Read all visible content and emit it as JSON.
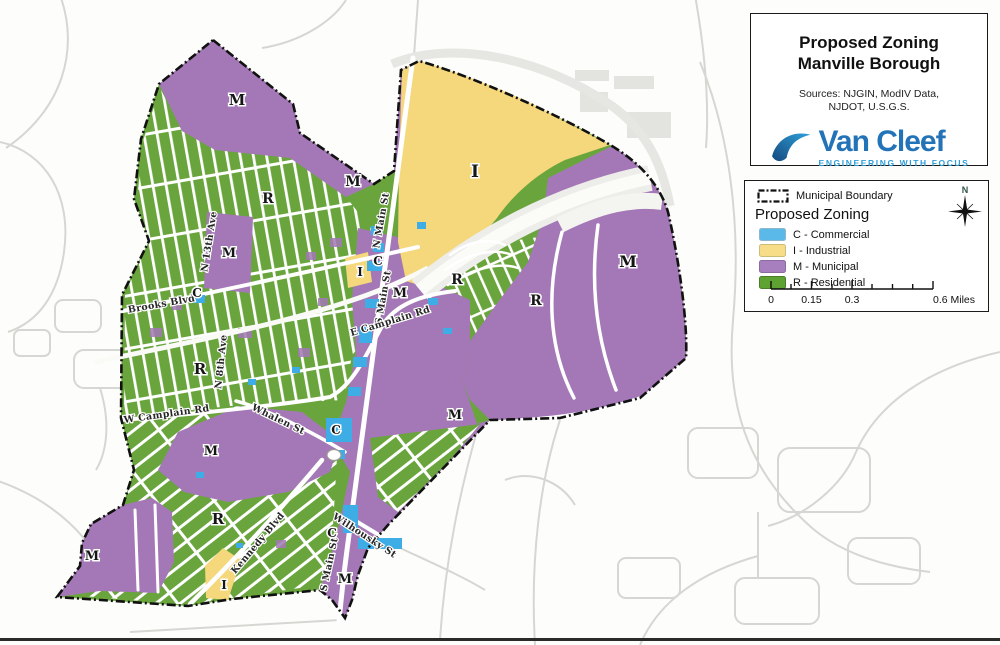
{
  "title_block": {
    "line1": "Proposed Zoning",
    "line2": "Manville Borough",
    "sources1": "Sources: NJGIN, ModIV Data,",
    "sources2": "NJDOT, U.S.G.S.",
    "logo_text": "Van Cleef",
    "logo_tagline": "ENGINEERING WITH FOCUS"
  },
  "legend": {
    "boundary_label": "Municipal Boundary",
    "heading": "Proposed Zoning",
    "items": [
      {
        "code": "C",
        "label": "C - Commercial",
        "color": "#5bb9ea"
      },
      {
        "code": "I",
        "label": "I - Industrial",
        "color": "#f8dd88"
      },
      {
        "code": "M",
        "label": "M - Municipal",
        "color": "#a87fbe"
      },
      {
        "code": "R",
        "label": "R - Residential",
        "color": "#5ea232"
      }
    ]
  },
  "scale_bar": {
    "labels": [
      "0",
      "0.15",
      "0.3",
      "0.6 Miles"
    ]
  },
  "north_label": "N",
  "colors": {
    "residential_green": "#69a53c",
    "municipal_purple": "#a478b6",
    "industrial_yellow": "#f5d77c",
    "commercial_blue": "#3fade5",
    "boundary_black": "#111111"
  },
  "map": {
    "zone_labels": [
      {
        "t": "M",
        "x": 237,
        "y": 105,
        "s": 15
      },
      {
        "t": "M",
        "x": 353,
        "y": 186,
        "s": 14
      },
      {
        "t": "I",
        "x": 475,
        "y": 177,
        "s": 17
      },
      {
        "t": "R",
        "x": 268,
        "y": 203,
        "s": 14
      },
      {
        "t": "M",
        "x": 229,
        "y": 257,
        "s": 13
      },
      {
        "t": "C",
        "x": 197,
        "y": 297,
        "s": 12
      },
      {
        "t": "I",
        "x": 360,
        "y": 276,
        "s": 12
      },
      {
        "t": "C",
        "x": 378,
        "y": 265,
        "s": 12
      },
      {
        "t": "M",
        "x": 400,
        "y": 297,
        "s": 13
      },
      {
        "t": "M",
        "x": 628,
        "y": 267,
        "s": 16
      },
      {
        "t": "R",
        "x": 457,
        "y": 284,
        "s": 14
      },
      {
        "t": "R",
        "x": 536,
        "y": 305,
        "s": 14
      },
      {
        "t": "R",
        "x": 200,
        "y": 374,
        "s": 15
      },
      {
        "t": "M",
        "x": 211,
        "y": 455,
        "s": 13
      },
      {
        "t": "C",
        "x": 336,
        "y": 434,
        "s": 12
      },
      {
        "t": "M",
        "x": 455,
        "y": 419,
        "s": 13
      },
      {
        "t": "R",
        "x": 218,
        "y": 524,
        "s": 15
      },
      {
        "t": "M",
        "x": 92,
        "y": 560,
        "s": 13
      },
      {
        "t": "C",
        "x": 332,
        "y": 537,
        "s": 12
      },
      {
        "t": "I",
        "x": 224,
        "y": 589,
        "s": 12
      },
      {
        "t": "M",
        "x": 345,
        "y": 583,
        "s": 13
      }
    ],
    "street_labels": [
      {
        "t": "Brooks Blvd",
        "x": 162,
        "y": 307,
        "r": -10
      },
      {
        "t": "N 13th Ave",
        "x": 212,
        "y": 242,
        "r": -81
      },
      {
        "t": "N 8th Ave",
        "x": 224,
        "y": 362,
        "r": -84
      },
      {
        "t": "N Main St",
        "x": 384,
        "y": 221,
        "r": -80
      },
      {
        "t": "S Main St",
        "x": 386,
        "y": 298,
        "r": -80
      },
      {
        "t": "E Camplain Rd",
        "x": 391,
        "y": 324,
        "r": -17
      },
      {
        "t": "W Camplain Rd",
        "x": 167,
        "y": 417,
        "r": -8
      },
      {
        "t": "Whalen St",
        "x": 277,
        "y": 422,
        "r": 26
      },
      {
        "t": "Kennedy Blvd",
        "x": 260,
        "y": 545,
        "r": -50
      },
      {
        "t": "Wilhousky St",
        "x": 363,
        "y": 538,
        "r": 33
      },
      {
        "t": "S Main St",
        "x": 332,
        "y": 565,
        "r": -78
      }
    ]
  }
}
